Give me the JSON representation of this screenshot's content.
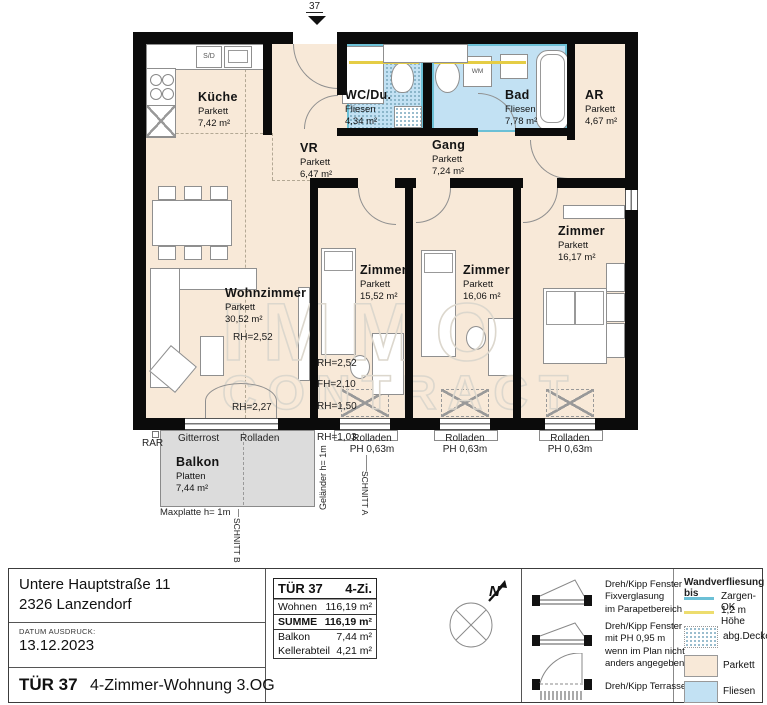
{
  "plan": {
    "entrance_marker": "37",
    "rooms": {
      "kueche": {
        "name": "Küche",
        "floor": "Parkett",
        "area": "7,42 m²"
      },
      "wc": {
        "name": "WC/Du.",
        "floor": "Fliesen",
        "area": "4,34 m²"
      },
      "bad": {
        "name": "Bad",
        "floor": "Fliesen",
        "area": "7,78 m²"
      },
      "ar": {
        "name": "AR",
        "floor": "Parkett",
        "area": "4,67 m²"
      },
      "vr": {
        "name": "VR",
        "floor": "Parkett",
        "area": "6,47 m²"
      },
      "gang": {
        "name": "Gang",
        "floor": "Parkett",
        "area": "7,24 m²"
      },
      "wohnzimmer": {
        "name": "Wohnzimmer",
        "floor": "Parkett",
        "area": "30,52 m²"
      },
      "zimmer1": {
        "name": "Zimmer",
        "floor": "Parkett",
        "area": "15,52 m²"
      },
      "zimmer2": {
        "name": "Zimmer",
        "floor": "Parkett",
        "area": "16,06 m²"
      },
      "zimmer3": {
        "name": "Zimmer",
        "floor": "Parkett",
        "area": "16,17 m²"
      },
      "balkon": {
        "name": "Balkon",
        "floor": "Platten",
        "area": "7,44 m²"
      }
    },
    "fixtures": {
      "sd": "S/D",
      "wm": "WM"
    },
    "annotations": {
      "rh_wohn": "RH=2,52",
      "rh_balkon_tuer": "RH=2,27",
      "rh_z1": "RH=2,52",
      "fh_z1": "FH=2,10",
      "rh_fenster": "RH=1,50",
      "rh_103": "RH=1,03",
      "rar": "RAR",
      "gitterrost": "Gitterrost",
      "rolladen": "Rolladen",
      "rolladen_ph_line1": "Rolladen",
      "rolladen_ph_line2": "PH 0,63m",
      "gelaender": "Geländer h= 1m",
      "maxplatte": "Maxplatte h= 1m",
      "schnitt_a": "SCHNITT A",
      "schnitt_b": "SCHNITT B"
    },
    "watermark": {
      "line1": "IMMO",
      "line2": "CONTRACT"
    }
  },
  "footer": {
    "address_line1": "Untere Hauptstraße 11",
    "address_line2": "2326 Lanzendorf",
    "datum_label": "DATUM AUSDRUCK:",
    "datum_value": "13.12.2023",
    "tuer_label": "TÜR 37",
    "tuer_desc": "4-Zimmer-Wohnung 3.OG",
    "north_label": "N",
    "table": {
      "header_left": "TÜR 37",
      "header_right": "4-Zi.",
      "rows": [
        {
          "label": "Wohnen",
          "value": "116,19 m²"
        },
        {
          "label": "SUMME",
          "value": "116,19 m²"
        },
        {
          "label": "Balkon",
          "value": "7,44 m²"
        },
        {
          "label": "Kellerabteil",
          "value": "4,21 m²"
        }
      ]
    },
    "legend": {
      "items": [
        {
          "lines": [
            "Dreh/Kipp Fenster",
            "Fixverglasung",
            "im Parapetbereich"
          ]
        },
        {
          "lines": [
            "Dreh/Kipp Fenster",
            "mit PH 0,95 m",
            "wenn im Plan nicht",
            "anders angegeben"
          ]
        },
        {
          "lines": [
            "Dreh/Kipp Terrassentür"
          ]
        }
      ],
      "tiling_header": "Wandverfliesung bis",
      "tiling_cyan": "Zargen-OK",
      "tiling_yellow": "1,2 m Höhe",
      "swatches": [
        {
          "label": "abg.Decke"
        },
        {
          "label": "Parkett"
        },
        {
          "label": "Fliesen"
        }
      ]
    }
  },
  "colors": {
    "parkett": "#f8e9d8",
    "fliesen": "#c2e1f3",
    "platten": "#dcdcdc",
    "cyan": "#6cc0d6",
    "yellow": "#e5cd45"
  }
}
